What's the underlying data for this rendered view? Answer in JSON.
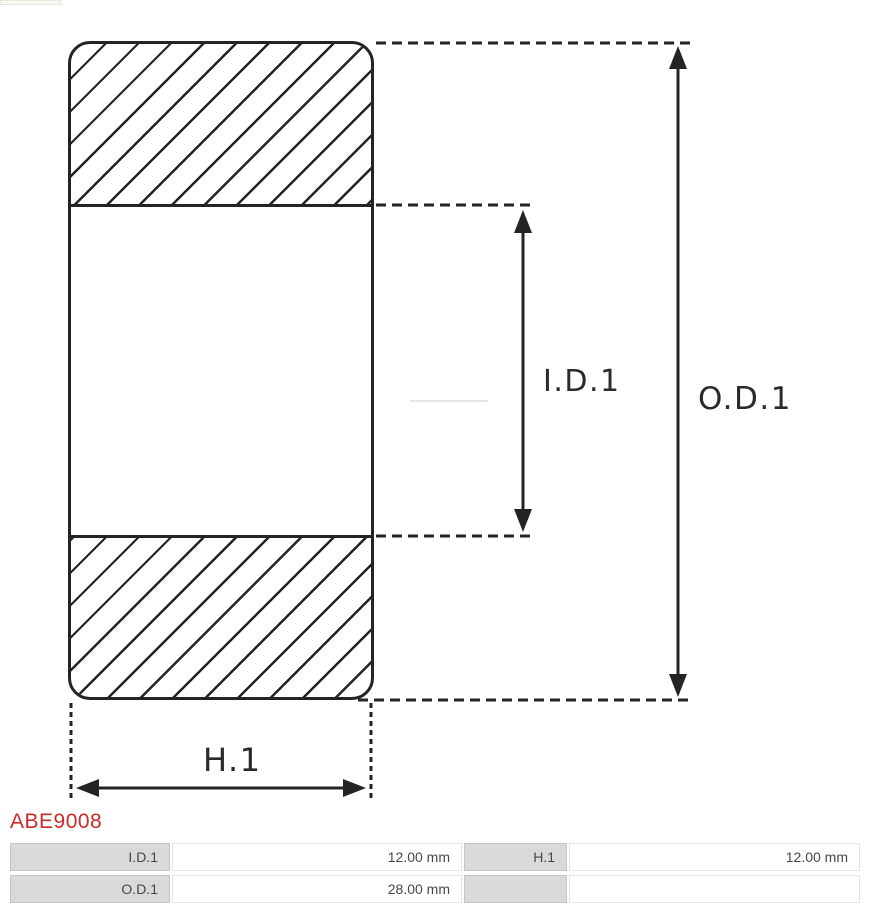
{
  "part_number": "ABE9008",
  "diagram": {
    "inner_diameter_label": "I.D.1",
    "outer_diameter_label": "O.D.1",
    "height_label": "H.1",
    "stroke_color": "#242424"
  },
  "specs": {
    "rows": [
      {
        "label1": "I.D.1",
        "value1": "12.00 mm",
        "label2": "H.1",
        "value2": "12.00 mm"
      },
      {
        "label1": "O.D.1",
        "value1": "28.00 mm",
        "label2": "",
        "value2": ""
      }
    ]
  },
  "accent_color": "#cb2b27",
  "table_gray": "#d9d9d9"
}
